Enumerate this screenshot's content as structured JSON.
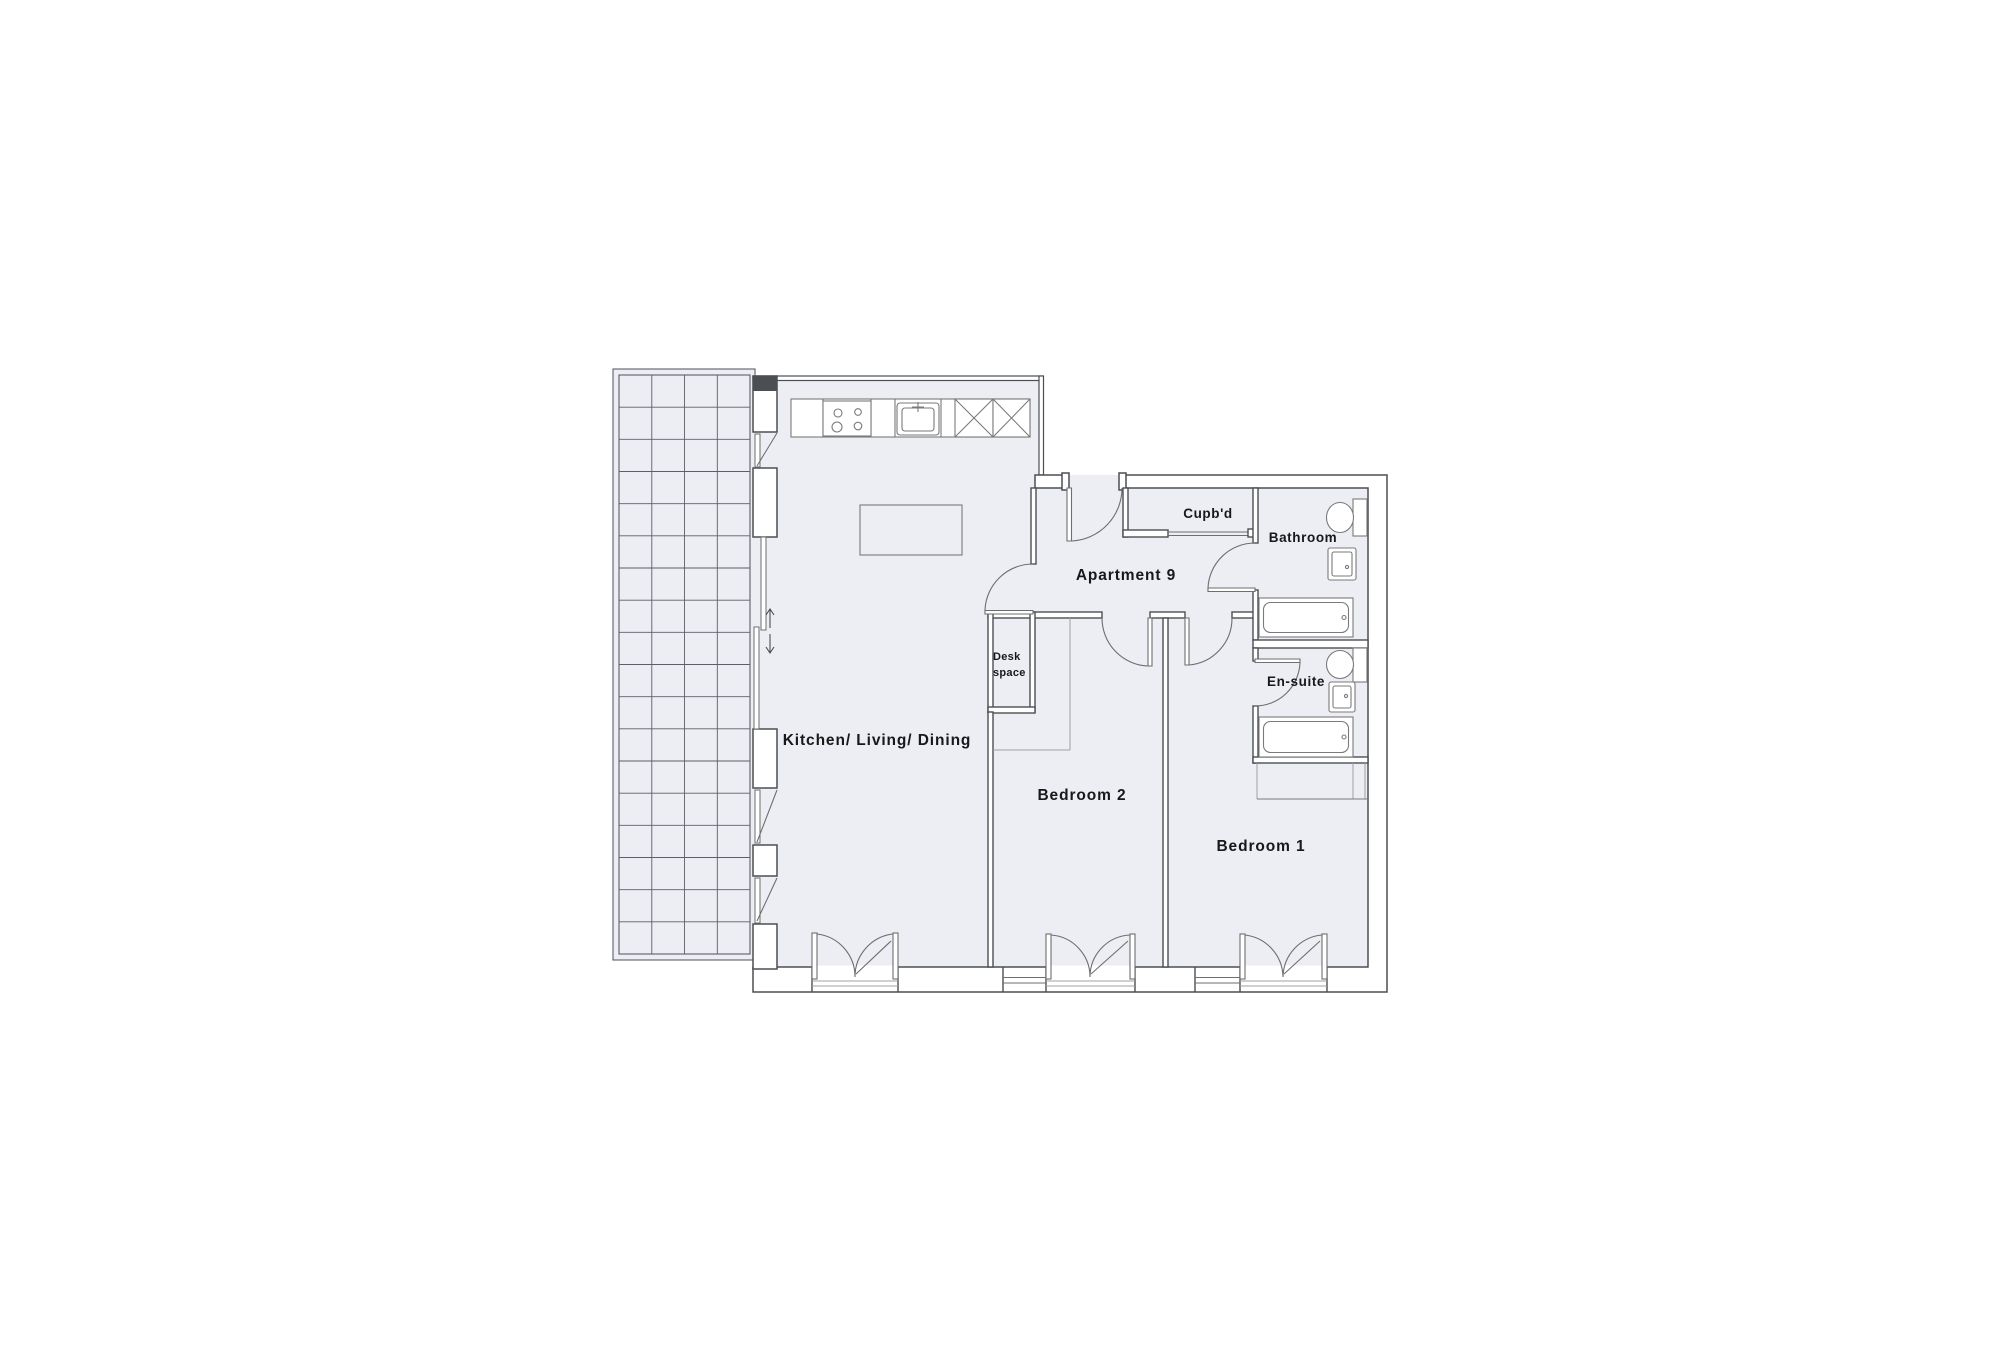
{
  "labels": {
    "kitchen_living_dining": "Kitchen/ Living/ Dining",
    "bedroom_2": "Bedroom 2",
    "bedroom_1": "Bedroom 1",
    "apartment": "Apartment 9",
    "cupboard": "Cupb'd",
    "bathroom": "Bathroom",
    "ensuite": "En-suite",
    "desk_space_line1": "Desk",
    "desk_space_line2": "space"
  },
  "colors": {
    "background": "#ffffff",
    "floor": "#ecPLACEHOLDER",
    "floor_fill": "#ec                    ",
    "wall": "#4b4e53",
    "fixture_line": "#7a7a7a",
    "door_line": "#6e6e6e",
    "thin_line": "#a0a0a0",
    "grid_line": "#5c5f66",
    "text": "#17181a"
  }
}
